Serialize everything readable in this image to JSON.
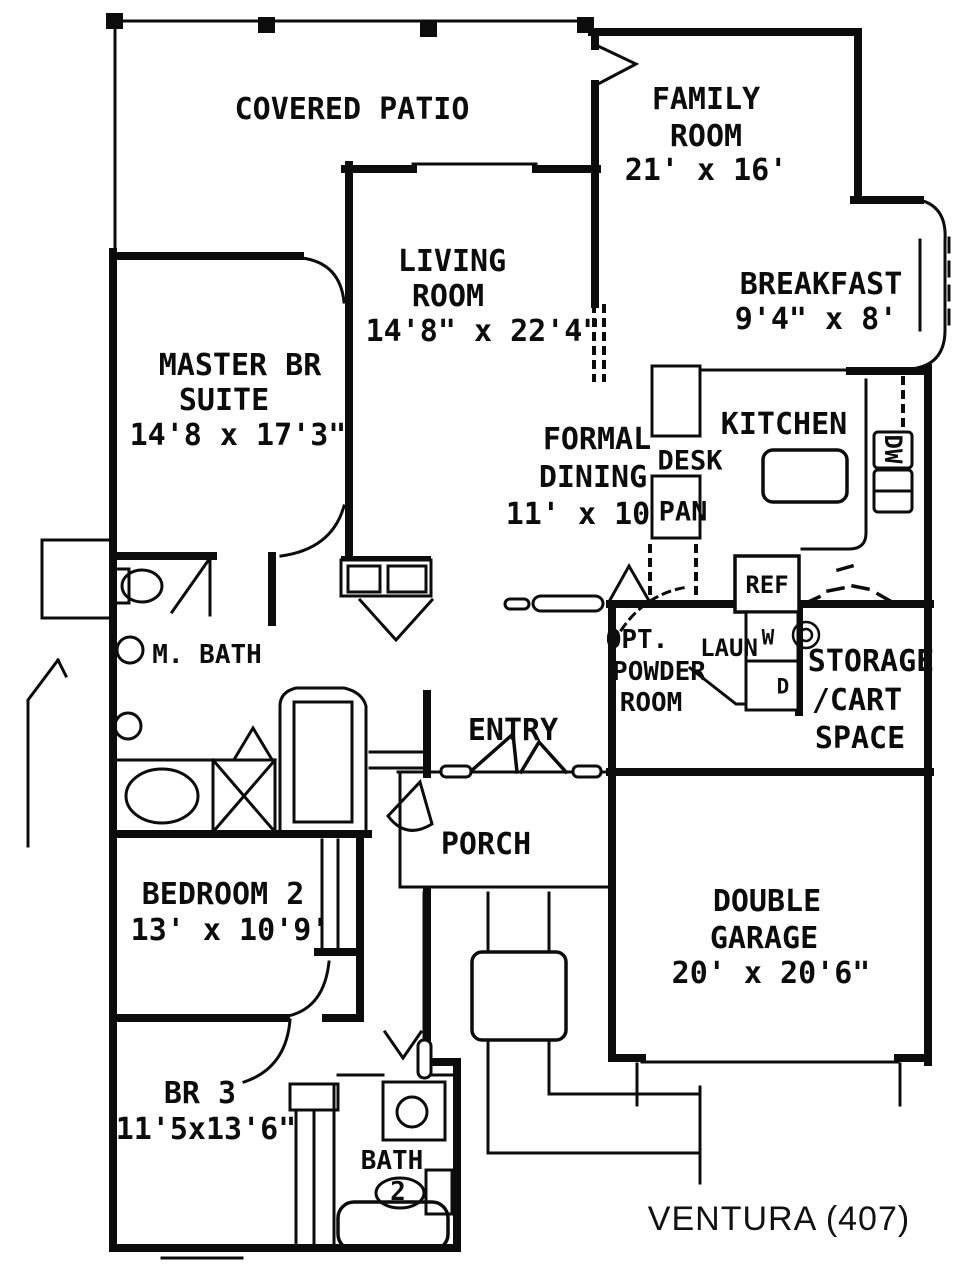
{
  "plan": {
    "title": "VENTURA (407)",
    "rooms": {
      "covered_patio": {
        "label": "COVERED PATIO"
      },
      "family_room": {
        "name1": "FAMILY",
        "name2": "ROOM",
        "dims": "21' x 16'"
      },
      "living_room": {
        "name1": "LIVING",
        "name2": "ROOM",
        "dims": "14'8\" x 22'4\""
      },
      "breakfast": {
        "name": "BREAKFAST",
        "dims": "9'4\" x 8'"
      },
      "master_suite": {
        "name1": "MASTER BR",
        "name2": "SUITE",
        "dims": "14'8 x 17'3\""
      },
      "formal_dining": {
        "name1": "FORMAL",
        "name2": "DINING",
        "dims": "11' x 10"
      },
      "kitchen": {
        "name": "KITCHEN"
      },
      "master_bath": {
        "name": "M. BATH"
      },
      "powder_room": {
        "name1": "OPT.",
        "name2": "POWDER",
        "name3": "ROOM"
      },
      "laundry": {
        "name": "LAUN"
      },
      "storage": {
        "name1": "STORAGE",
        "name2": "/CART",
        "name3": "SPACE"
      },
      "entry": {
        "name": "ENTRY"
      },
      "porch": {
        "name": "PORCH"
      },
      "bedroom2": {
        "name": "BEDROOM 2",
        "dims": "13' x 10'9'"
      },
      "garage": {
        "name1": "DOUBLE",
        "name2": "GARAGE",
        "dims": "20' x 20'6\""
      },
      "bedroom3": {
        "name": "BR 3",
        "dims": "11'5x13'6\""
      },
      "bath2": {
        "name1": "BATH",
        "name2": "2"
      }
    },
    "appliances": {
      "desk": "DESK",
      "pantry": "PAN",
      "dishwasher": "DW",
      "refrigerator": "REF",
      "washer": "W",
      "dryer": "D"
    },
    "ink_color": "#0c0c0c",
    "paper_color": "#ffffff"
  }
}
